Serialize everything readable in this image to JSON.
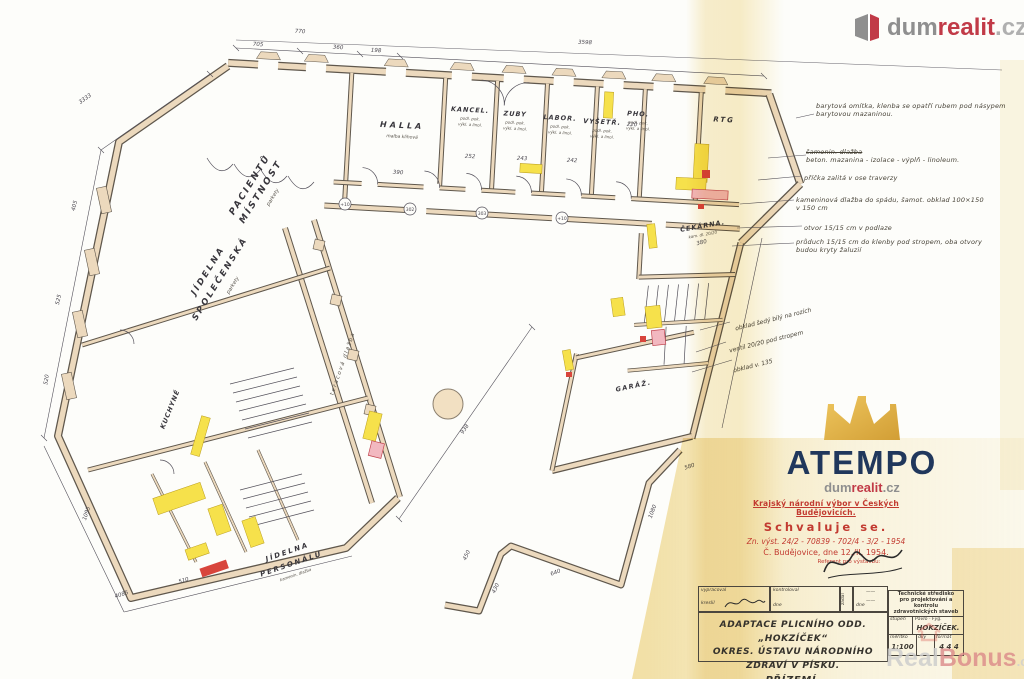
{
  "branding": {
    "dumrealit": {
      "dum": "dum",
      "realit": "realit",
      "cz": ".cz"
    },
    "atempo": {
      "name": "ATEMPO",
      "dum": "dum",
      "realit": "realit",
      "cz": ".cz"
    },
    "realbonus": {
      "real": "Real",
      "bonus": "Bonus",
      "cz": ".cz"
    }
  },
  "approval_stamp": {
    "header": "Krajský národní výbor v Českých Budějovicích.",
    "approve": "Schvaluje se.",
    "ref": "Zn. výst. 24/2 - 70839 - 702/4 - 3/2 - 1954",
    "place_date": "Č. Budějovice, dne 12./II. 1954.",
    "referent": "Referent pro výstavbu:"
  },
  "title_block": {
    "vypracoval": "vypracoval",
    "kreslil": "kreslil",
    "kontroloval": "kontroloval",
    "dne": "dne",
    "zadal": "zadal",
    "title1": "ADAPTACE PLICNÍHO ODD. „HOKZÍČEK“",
    "title2": "OKRES. ÚSTAVU NÁRODNÍHO ZDRAVÍ V PÍSKU.",
    "title3": "PŘÍZEMÍ.",
    "agency1": "Technické středisko",
    "agency2": "pro projektování a kontrolu",
    "agency3": "zdravotnických staveb",
    "stupen": "stupeň",
    "pavlo": "Pavlo - Fyg.",
    "project": "HOKZÍČEK.",
    "meritko": "měřítko",
    "scale": "1:100",
    "dily": "díly",
    "format": "formát",
    "format_value": "4 4 4"
  },
  "rooms": [
    {
      "name": "PACIENTŮ",
      "name2": "MÍSTNOST",
      "sub": "parkety"
    },
    {
      "name": "HALLA",
      "sub": "malba klihová"
    },
    {
      "name": "KANCEL."
    },
    {
      "name": "ZUBY"
    },
    {
      "name": "LABOR."
    },
    {
      "name": "VYŠETŘ."
    },
    {
      "name": "PHO."
    },
    {
      "name": "RTG"
    },
    {
      "name": "ČEKÁRNA.",
      "sub": "kam. dl. 20/20"
    },
    {
      "name": "JÍDELNA",
      "name2": "SPOLEČENSKÁ",
      "sub": "parkety"
    },
    {
      "name": "teracová dlažba"
    },
    {
      "name": "KUCHYNĚ"
    },
    {
      "name": "JÍDELNA",
      "name2": "PERSONÁLU",
      "sub": "kamenin. dlažba"
    },
    {
      "name": "GARÁŽ."
    }
  ],
  "finish_note1": "podl. pok.",
  "finish_note2": "výkl. a linol.",
  "annotations": [
    {
      "text": "barytová omítka, klenba se opatří rubem pod násypem barytovou mazaninou."
    },
    {
      "struck": "šamonin. dlažba",
      "text": "beton. mazanina - izolace - výplň - linoleum."
    },
    {
      "text": "příčka zalitá v ose traverzy"
    },
    {
      "text": "kameninová dlažba do spádu, šamot. obklad 100×150 v 150 cm"
    },
    {
      "text": "otvor 15/15 cm v podlaze"
    },
    {
      "text": "průduch 15/15 cm do klenby pod stropem, oba otvory budou kryty žaluzií"
    }
  ],
  "garage_notes": [
    "obklad šedý bílý na rozích",
    "ventil 20/20 pod stropem",
    "obklad v. 135"
  ],
  "dims": [
    "770",
    "705",
    "360",
    "198",
    "3598",
    "390",
    "220",
    "380",
    "3333",
    "405",
    "525",
    "520",
    "938",
    "640",
    "450",
    "430",
    "1080",
    "510",
    "4085",
    "1095",
    "252",
    "243",
    "242",
    "580"
  ],
  "level_marks": [
    "+10",
    "302",
    "303",
    "+10"
  ]
}
